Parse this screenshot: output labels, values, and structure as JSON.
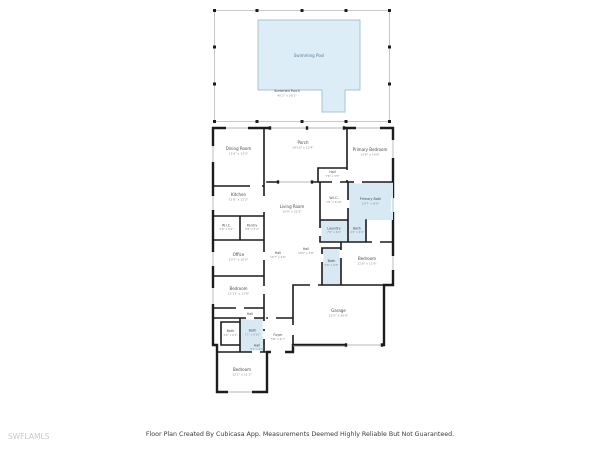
{
  "watermark": {
    "text": "SWFLAMLS"
  },
  "footer": {
    "text": "Floor Plan Created By Cubicasa App. Measurements Deemed Highly Reliable But Not Guaranteed."
  },
  "colors": {
    "wall": "#1c1c1c",
    "pool_fill": "#ddedf8",
    "pool_edge": "#a9c4d2",
    "wet_room_fill": "#d9e9f4",
    "screen_line": "#b8b8b8",
    "label": "#4a4a4a",
    "dims": "#8a8a8a",
    "watermark": "#c9c9c9"
  },
  "rooms": {
    "swimming_pool": {
      "label": "Swimming Pool"
    },
    "screened_porch": {
      "label": "Screened Porch",
      "dims": "40'2\" x 26'1\""
    },
    "dining": {
      "label": "Dining Room",
      "dims": "11'6\" x 13'5\""
    },
    "porch": {
      "label": "Porch",
      "dims": "19'10\" x 12'4\""
    },
    "primary_bedroom": {
      "label": "Primary Bedroom",
      "dims": "13'8\" x 14'6\""
    },
    "hall_top": {
      "label": "Hall",
      "dims": "7'8\" x 3'5\""
    },
    "wic_primary": {
      "label": "W.I.C.",
      "dims": "7'6\" x 6'10\""
    },
    "primary_bath": {
      "label": "Primary Bath",
      "dims": "10'7\" x 8'9\""
    },
    "kitchen": {
      "label": "Kitchen",
      "dims": "11'6\" x 11'2\""
    },
    "living": {
      "label": "Living Room",
      "dims": "15'9\" x 22'3\""
    },
    "laundry": {
      "label": "Laundry",
      "dims": "7'6\" x 6'0\""
    },
    "bath_small": {
      "label": "Bath",
      "dims": "4'9\" x 6'0\""
    },
    "wic_left": {
      "label": "W.I.C.",
      "dims": "5'6\" x 5'2\""
    },
    "pantry": {
      "label": "Pantry",
      "dims": "5'8\" x 5'2\""
    },
    "office": {
      "label": "Office",
      "dims": "10'7\" x 10'0\""
    },
    "hall_center": {
      "label": "Hall",
      "dims": "13'7\" x 4'6\""
    },
    "hall_garage": {
      "label": "Hall",
      "dims": "10'5\" x 3'8\""
    },
    "bedroom_right": {
      "label": "Bedroom",
      "dims": "11'8\" x 11'9\""
    },
    "bath_mid": {
      "label": "Bath",
      "dims": "5'6\" x 9'5\""
    },
    "garage": {
      "label": "Garage",
      "dims": "21'0\" x 20'6\""
    },
    "bedroom_left": {
      "label": "Bedroom",
      "dims": "12'11\" x 11'8\""
    },
    "hall_left": {
      "label": "Hall"
    },
    "bath_left_small": {
      "label": "Bath",
      "dims": "5'6\" x 6'1\""
    },
    "bath_left_blue": {
      "label": "Bath",
      "dims": "7'1\" x 9'10\""
    },
    "hall_bottom": {
      "label": "Hall",
      "dims": "3'1\" x 4'5\""
    },
    "foyer": {
      "label": "Foyer",
      "dims": "5'8\" x 6'7\""
    },
    "bedroom_bottom": {
      "label": "Bedroom",
      "dims": "12'1\" x 11'1\""
    }
  }
}
